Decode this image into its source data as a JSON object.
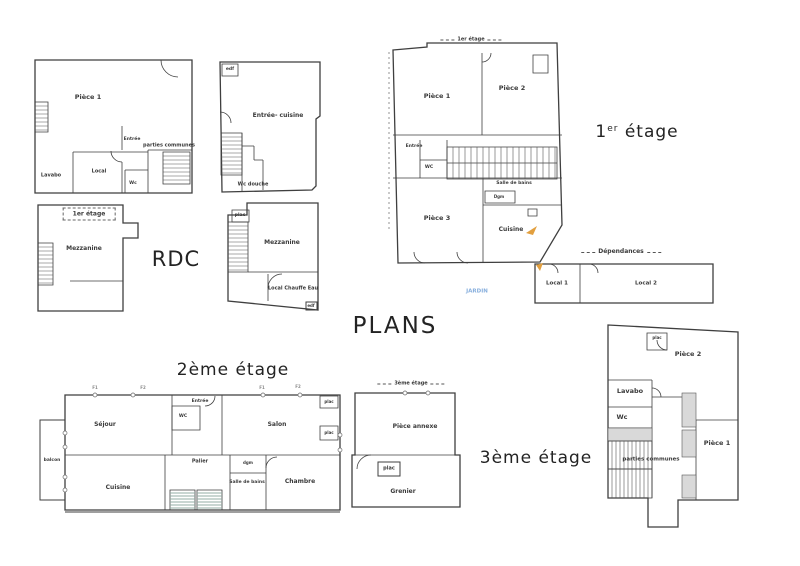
{
  "page_title": "PLANS",
  "floor_titles": {
    "rdc": "RDC",
    "first_num": "1",
    "first_sup": "er",
    "first_rest": " étage",
    "second": "2ème étage",
    "third": "3ème étage"
  },
  "plans": {
    "rdc_main": {
      "piece1": "Pièce 1",
      "entree": "Entrée",
      "parties_communes": "parties communes",
      "lavabo": "Lavabo",
      "local": "Local",
      "wc": "Wc"
    },
    "rdc_mezzanine": {
      "header": "1er étage",
      "mezzanine": "Mezzanine"
    },
    "annex_ground": {
      "edf": "edf",
      "entree_cuisine": "Entrée- cuisine",
      "wc_douche": "Wc douche"
    },
    "annex_mezzanine": {
      "plac": "plac",
      "mezzanine": "Mezzanine",
      "local_chauffe_eau": "Local Chauffe Eau",
      "edf": "edf"
    },
    "first_floor": {
      "header": "1er étage",
      "piece1": "Pièce 1",
      "piece2": "Pièce 2",
      "entree": "Entrée",
      "wc": "WC",
      "salle_de_bains": "Salle de bains",
      "dgm": "Dgm",
      "piece3": "Pièce 3",
      "cuisine": "Cuisine",
      "dependances": "Dépendances",
      "jardin": "JARDIN",
      "local1": "Local 1",
      "local2": "Local 2"
    },
    "second_floor": {
      "sejour": "Séjour",
      "entree": "Entrée",
      "wc": "WC",
      "salon": "Salon",
      "balcon": "balcon",
      "cuisine": "Cuisine",
      "palier": "Palier",
      "dgm": "dgm",
      "salle_de_bains": "Salle de bains",
      "chambre": "Chambre",
      "plac_top": "plac",
      "plac_bottom": "plac",
      "win1": "F1",
      "win2": "F2",
      "win3": "F1",
      "win4": "F2"
    },
    "third_floor_annex": {
      "header": "3ème étage",
      "piece_annexe": "Pièce annexe",
      "plac": "plac",
      "grenier": "Grenier"
    },
    "third_floor": {
      "piece2": "Pièce 2",
      "plac": "plac",
      "lavabo": "Lavabo",
      "wc": "Wc",
      "parties_communes": "parties communes",
      "piece1": "Pièce 1"
    }
  },
  "colors": {
    "wall": "#3f3f3f",
    "label": "#3a3a3a",
    "jardin_text": "#86aedd",
    "marker_orange": "#e29f3e",
    "stair_tread_green": "#93aca4",
    "stipple_gray": "#d9d9d9"
  }
}
